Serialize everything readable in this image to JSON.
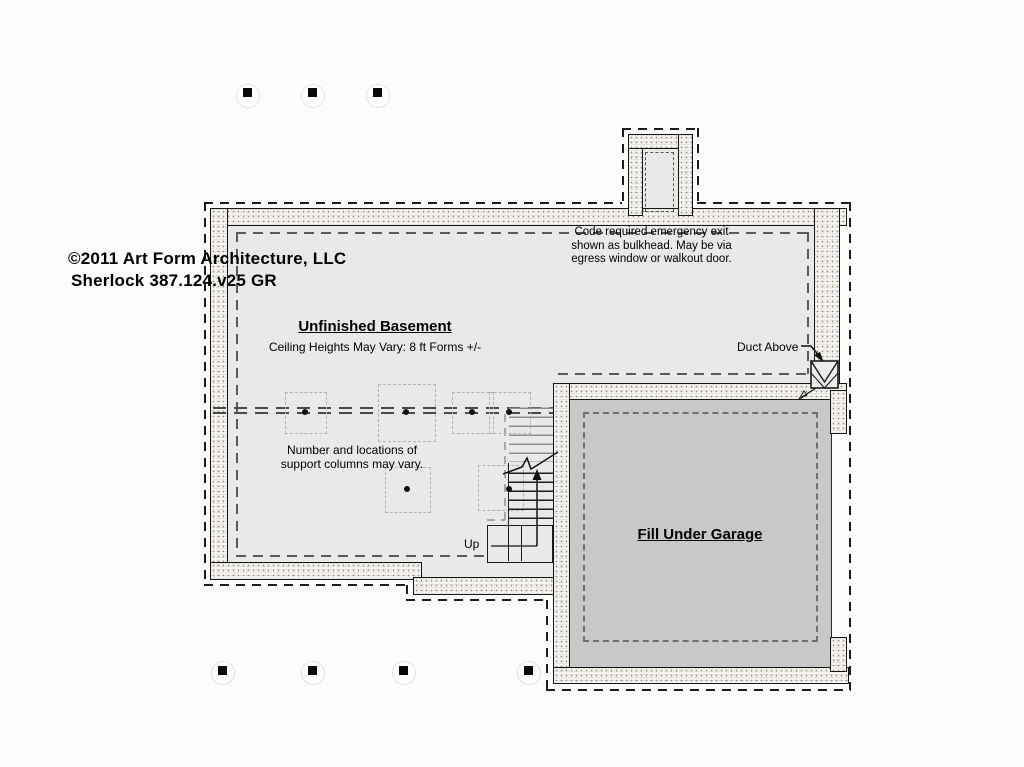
{
  "titleblock": {
    "copyright": "©2011 Art Form Architecture, LLC",
    "model": "Sherlock 387.124.v25 GR"
  },
  "labels": {
    "egress_note": "Code required emergency exit shown as bulkhead. May be via egress window or walkout door.",
    "room_title": "Unfinished Basement",
    "ceiling_note": "Ceiling Heights May Vary: 8 ft Forms +/-",
    "columns_note": "Number and locations of support columns may vary.",
    "duct_label": "Duct Above",
    "garage_label": "Fill Under Garage",
    "up_label": "Up"
  },
  "colors": {
    "background": "#fcfcfc",
    "basement_floor": "#e9e9e9",
    "garage_fill": "#c8c8c8",
    "wall_stipple": "#f7f5f1",
    "line": "#161616"
  },
  "symbols": {
    "duct": "duct-above-symbol",
    "posts": "deck-post-footing",
    "columns": "support-column"
  }
}
